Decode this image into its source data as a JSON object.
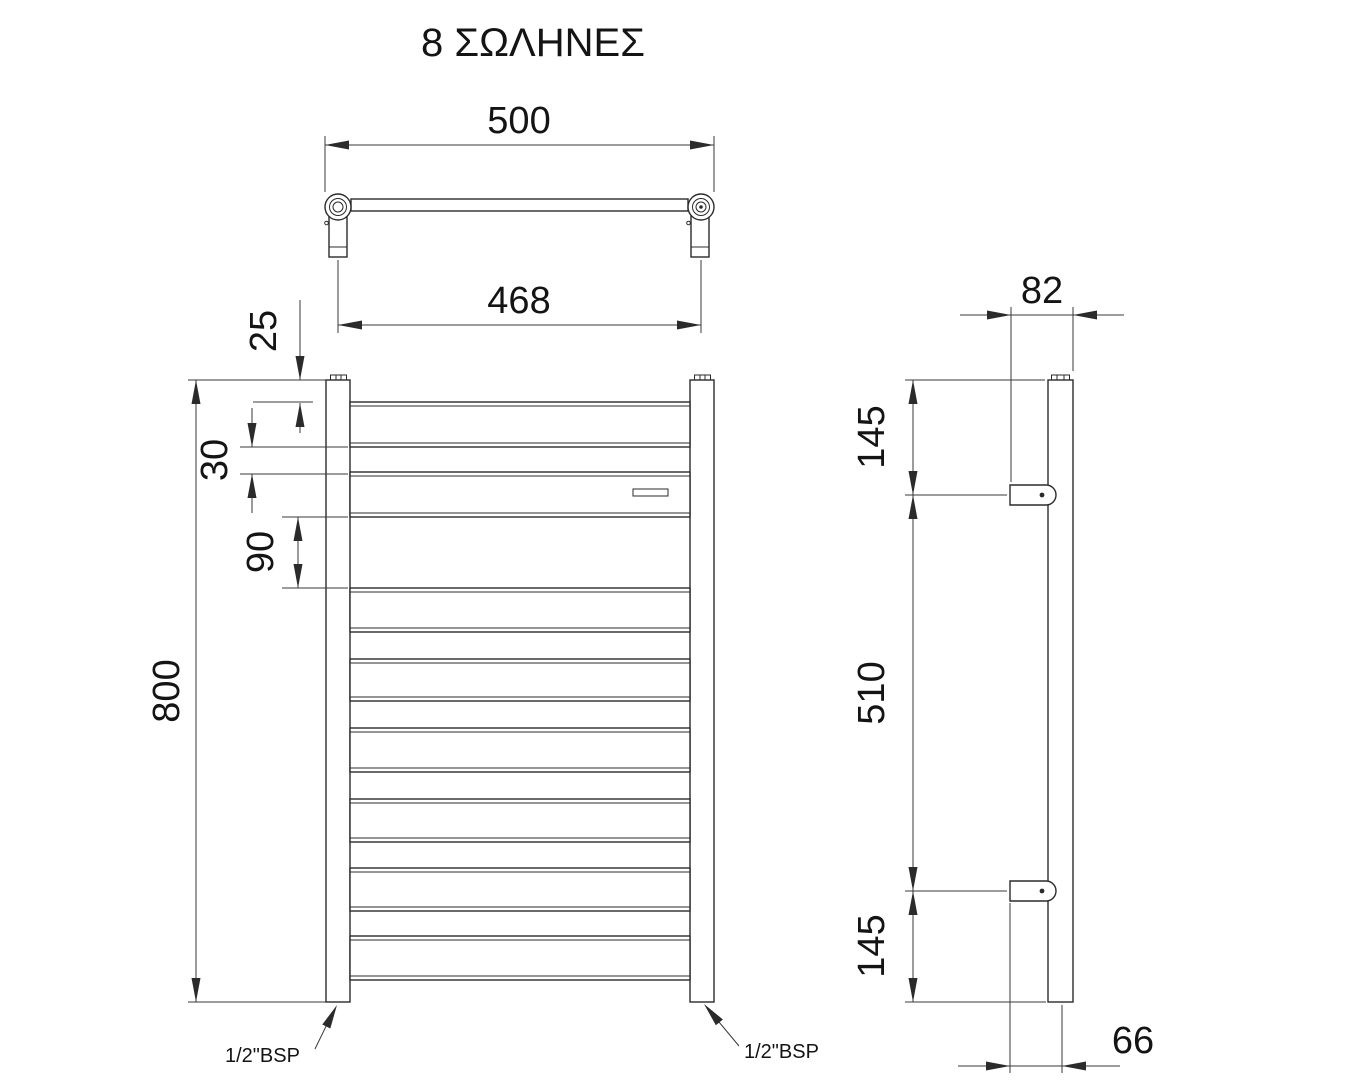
{
  "title": "8 ΣΩΛΗΝΕΣ",
  "top_view": {
    "overall_width": "500",
    "fixing_centers": "468"
  },
  "front_view": {
    "top_to_first_tube": "25",
    "tube_spacing": "30",
    "group_spacing": "90",
    "overall_height": "800",
    "connection_left": "1/2\"BSP",
    "connection_right": "1/2\"BSP"
  },
  "side_view": {
    "overall_depth": "82",
    "top_to_bracket": "145",
    "bracket_centers": "510",
    "bracket_to_bottom": "145",
    "wall_to_pipe_center": "66"
  },
  "line_color": "#2b2b2b"
}
